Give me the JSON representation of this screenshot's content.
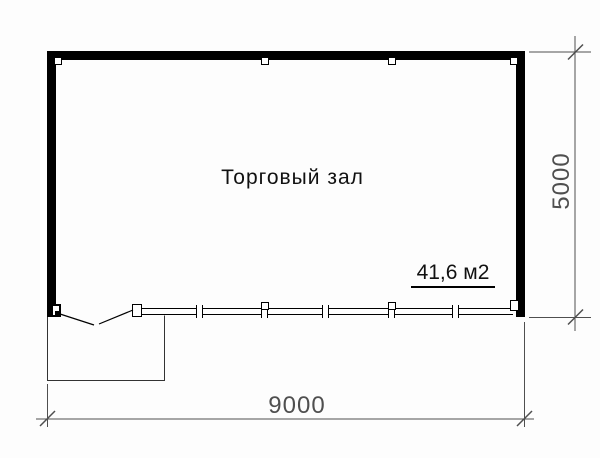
{
  "plan": {
    "room_label": "Торговый зал",
    "area_label": "41,6 м2"
  },
  "dimensions": {
    "width_label": "9000",
    "height_label": "5000"
  },
  "colors": {
    "background": "#fdfdfd",
    "wall": "#000000",
    "porch_line": "#333333",
    "dimension": "#4f4f4f"
  }
}
